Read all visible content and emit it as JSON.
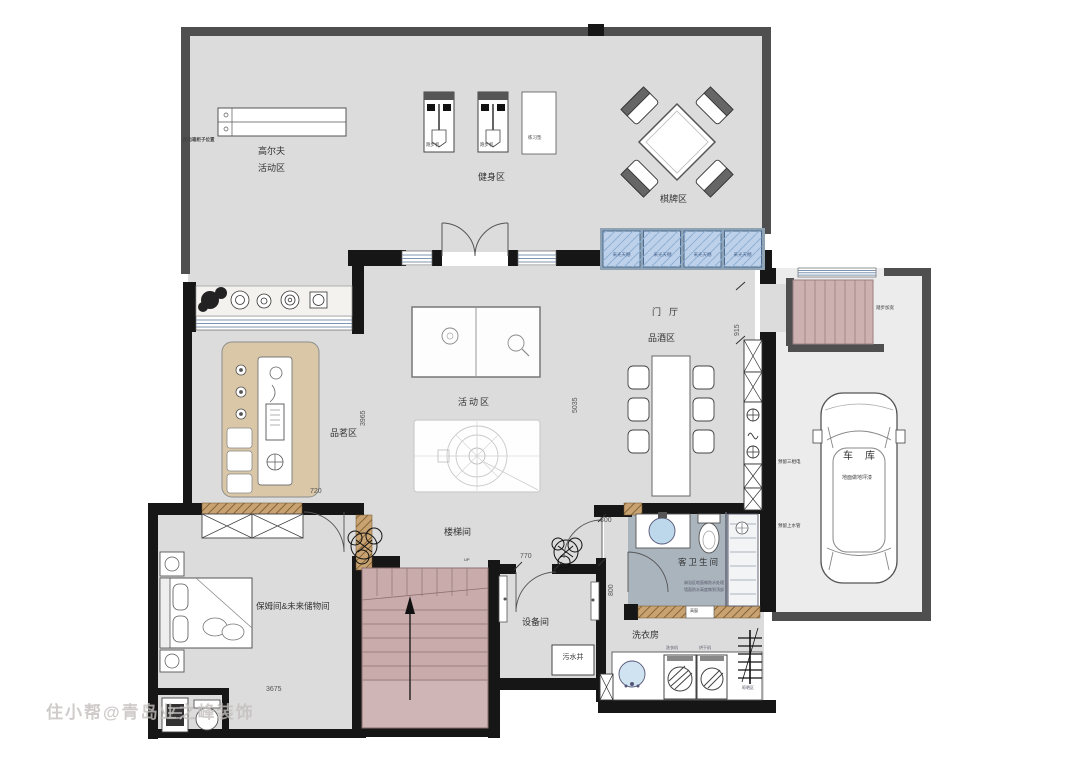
{
  "watermark": "住小帮@青岛业之峰装饰",
  "rooms": {
    "golf_line1": "高尔夫",
    "golf_line2": "活动区",
    "fitness": "健身区",
    "chess": "棋牌区",
    "foyer": "门厅",
    "wine_area": "品酒区",
    "activity": "活动区",
    "tea_area": "品茗区",
    "stairwell": "楼梯间",
    "nanny_storage": "保姆间&未来储物间",
    "equipment": "设备间",
    "laundry": "洗衣房",
    "guest_bath": "客卫生间",
    "garage": "车库"
  },
  "labels": {
    "treadmill": "跑步机",
    "mat": "练习垫",
    "skylight": "采光天棚",
    "sewage_well": "污水井",
    "washer": "洗衣机",
    "dryer": "烘干机",
    "drying_area": "晾晒区",
    "high_window": "高窗",
    "up": "UP"
  },
  "annotations": {
    "distribution_box": "配电箱柜子位置",
    "steps_widen": "踏步加宽",
    "three_phase_power": "预留三相电",
    "garage_floor": "地面做地坪漆",
    "water_supply": "预留上水管",
    "bath_note_line1": "淋浴区地面做防水处理",
    "bath_note_line2": "墙面防水高度做到顶部"
  },
  "dimensions": {
    "entry_width": "915",
    "tea_depth": "3965",
    "hall_depth": "5035",
    "tea_width": "720",
    "equip_door": "770",
    "bath_door_w": "800",
    "bath_door_h": "800",
    "nanny_width": "3675"
  },
  "colors": {
    "floor": "#dcdcdc",
    "wall_dark": "#4f4f4f",
    "wall_black": "#161616",
    "skylight_blue": "#bdd2ea",
    "stairs_pink": "#c9abab",
    "cabinet_tan": "#d9c7a7",
    "bath_floor": "#aab4bd"
  }
}
